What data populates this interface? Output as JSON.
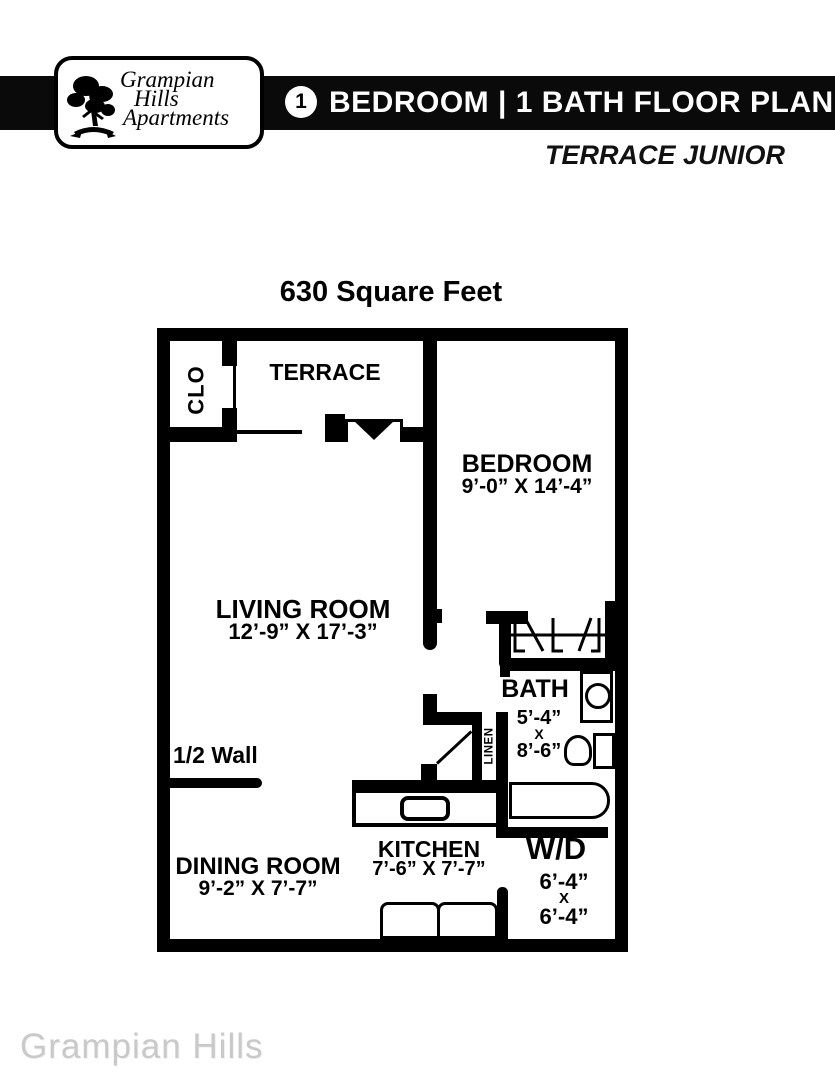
{
  "header": {
    "logo": {
      "line1": "Grampian",
      "line2": "Hills",
      "line3": "Apartments",
      "icon": "tree-logo"
    },
    "badge": "1",
    "title": "BEDROOM  |  1 BATH FLOOR PLAN",
    "subtitle": "TERRACE JUNIOR"
  },
  "plan": {
    "area": "630 Square Feet",
    "rooms": {
      "clo": {
        "label": "CLO"
      },
      "terrace": {
        "label": "TERRACE"
      },
      "bedroom": {
        "label": "BEDROOM",
        "dims": "9’-0” X 14’-4”"
      },
      "living": {
        "label": "LIVING ROOM",
        "dims": "12’-9” X 17’-3”"
      },
      "bath": {
        "label": "BATH",
        "w": "5’-4”",
        "x": "X",
        "h": "8’-6”"
      },
      "linen": {
        "label": "LINEN"
      },
      "dining": {
        "label": "DINING ROOM",
        "dims": "9’-2” X 7’-7”"
      },
      "kitchen": {
        "label": "KITCHEN",
        "dims": "7’-6” X 7’-7”"
      },
      "wd": {
        "label": "W/D",
        "w": "6’-4”",
        "x": "X",
        "h": "6’-4”"
      }
    },
    "annotations": {
      "half_wall": "1/2 Wall"
    }
  },
  "watermark": "Grampian Hills",
  "colors": {
    "ink": "#000000",
    "paper": "#ffffff",
    "bar": "#0a0a0a",
    "watermark": "#c9c9c9"
  }
}
